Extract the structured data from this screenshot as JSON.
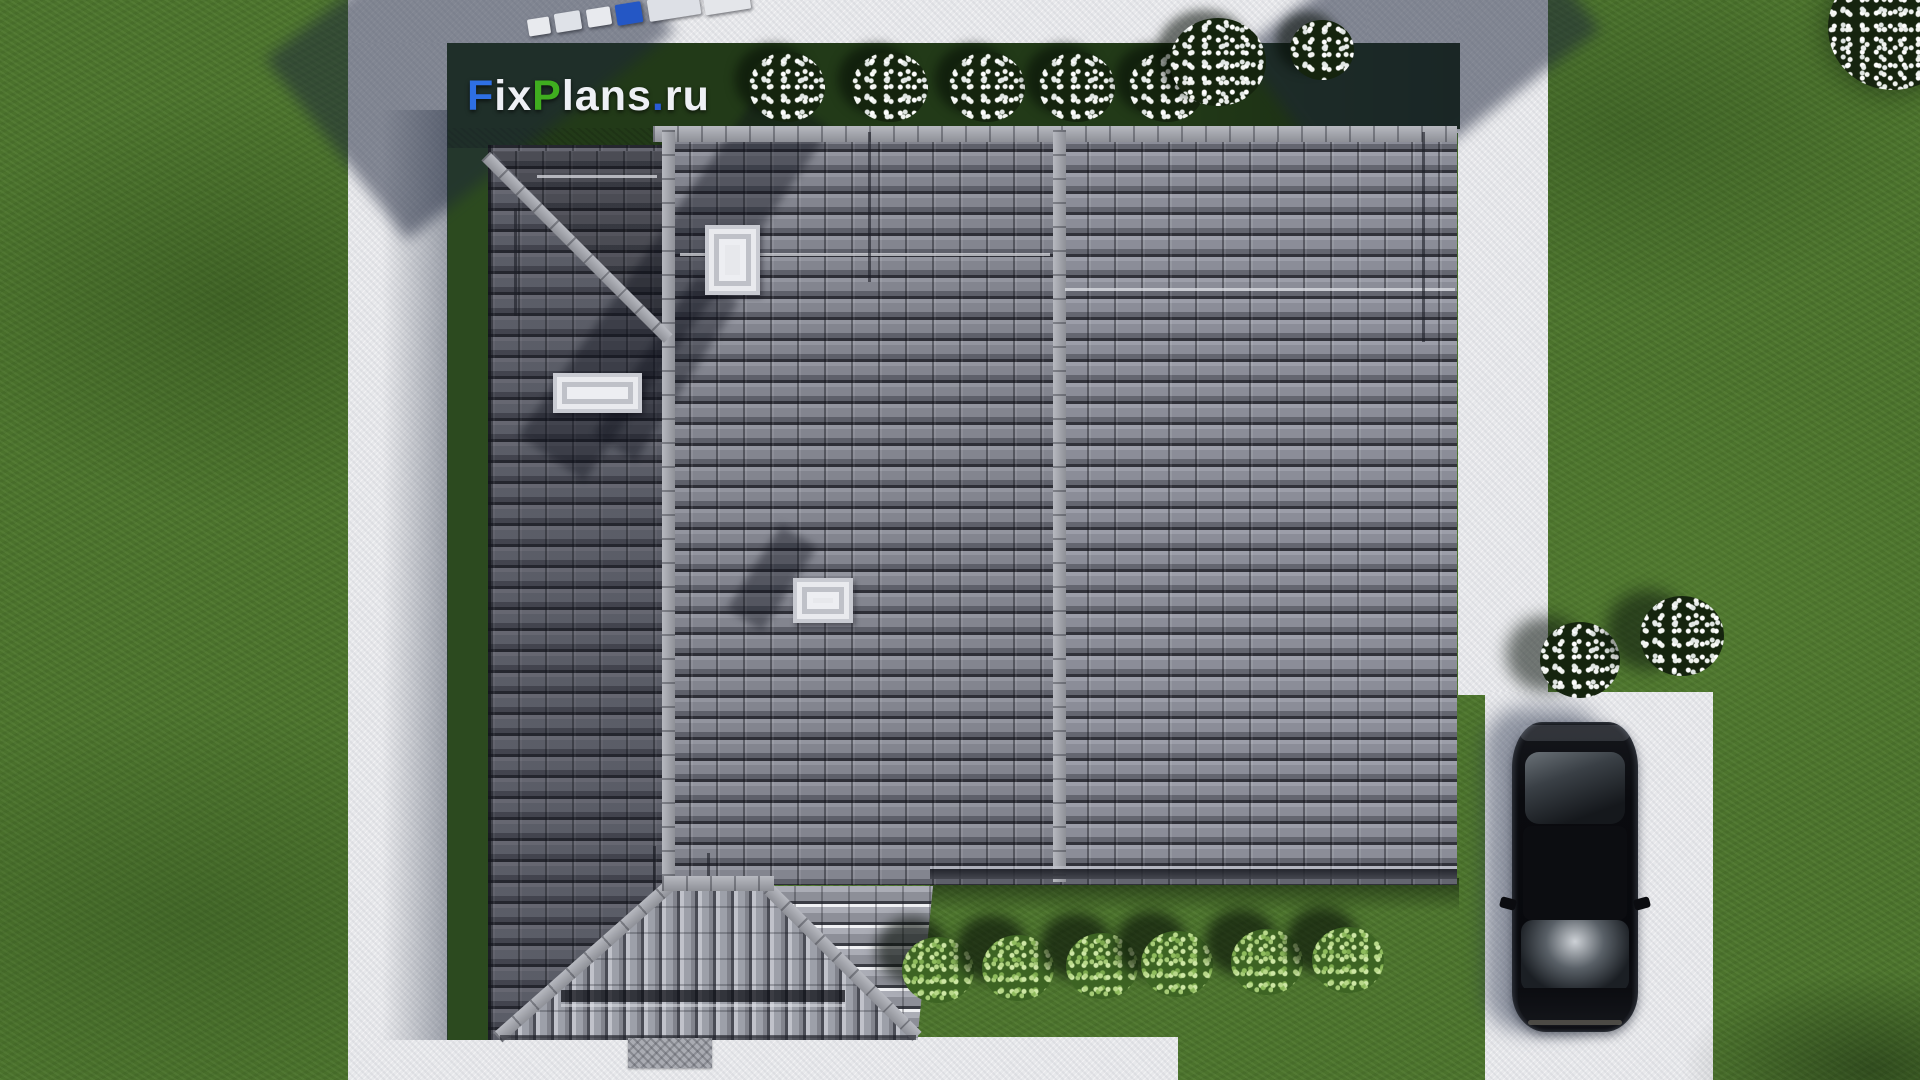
{
  "watermark": {
    "text": "FixPlans.ru",
    "parts": [
      {
        "text": "F",
        "color": "#2e6fe4"
      },
      {
        "text": "ix",
        "color": "#eef0f5"
      },
      {
        "text": "P",
        "color": "#3fae1f"
      },
      {
        "text": "lans",
        "color": "#eef0f5"
      },
      {
        "text": ".",
        "color": "#2a5cd8"
      },
      {
        "text": "ru",
        "color": "#eef0f5"
      }
    ]
  },
  "scene": {
    "description": "Aerial top-down 3D architectural render of a house with gray tiled hip roof, lawn, concrete walkways, driveway with parked black car, flowering and green bushes",
    "palette": {
      "grass": "#4e772e",
      "grass_shadow": "#223a18",
      "walkway": "#e7e8eb",
      "roof_tile": "#7e8089",
      "roof_tile_gap": "#2e2f37",
      "ridge_cap": "#a6a8b0",
      "skylight": "#e7e8ec",
      "car_body": "#0a0b0f",
      "flower_bush_dot": "#f2f4f0",
      "green_bush": "#8fbc5d"
    },
    "objects": {
      "roof_sections": 3,
      "chimneys": 1,
      "skylights": 2,
      "flowering_bushes_top_row": 7,
      "flowering_bushes_right": 2,
      "green_bushes_bottom_row": 6,
      "cars": 1,
      "delivery_boxes_top": 6
    }
  }
}
